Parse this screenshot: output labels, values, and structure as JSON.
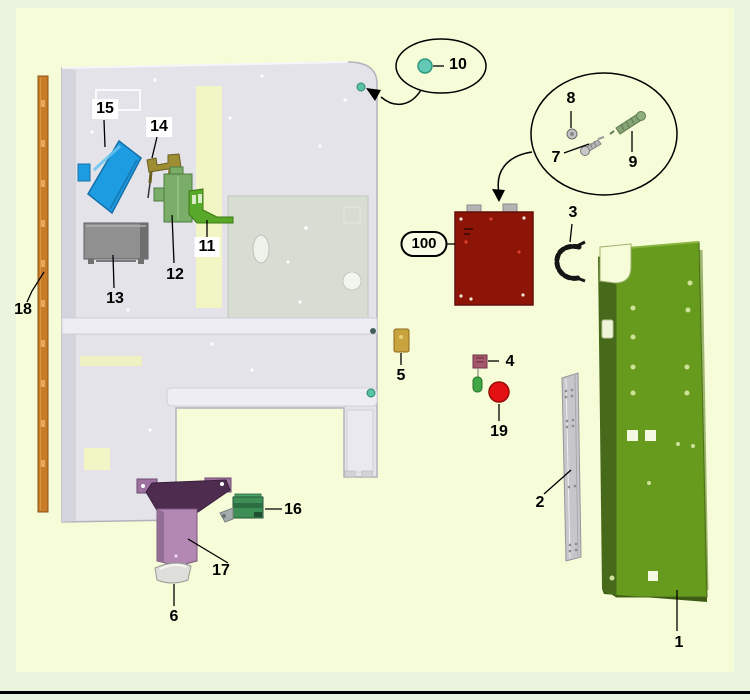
{
  "diagram": {
    "type": "exploded-parts-diagram",
    "callouts": {
      "c1": "1",
      "c2": "2",
      "c3": "3",
      "c4": "4",
      "c5": "5",
      "c6": "6",
      "c7": "7",
      "c8": "8",
      "c9": "9",
      "c10": "10",
      "c11": "11",
      "c12": "12",
      "c13": "13",
      "c14": "14",
      "c15": "15",
      "c16": "16",
      "c17": "17",
      "c18": "18",
      "c19": "19",
      "c100": "100"
    },
    "palette": {
      "background_outer": "#ebf4de",
      "background_inner": "#f6fbd8",
      "bottom_rule": "#000000",
      "mounting_panel": "#e3e3e9",
      "panel_recess": "#d7ddd3",
      "panel_yellow_strip": "#f2f5c4",
      "green_cabinet": "#679b1e",
      "green_cabinet_side": "#47691a",
      "red_module": "#8c1507",
      "blue_chute": "#1e9ce2",
      "purple_hopper_body": "#b287b2",
      "purple_hopper_top": "#4e2c50",
      "white_scoop": "#dededa",
      "brown_rail": "#c97c28",
      "gray_rail": "#c6c6cb",
      "gray_box": "#909090",
      "green_bracket_bright": "#58a829",
      "green_bracket_medium": "#79ad68",
      "olive_bracket": "#9d8d33",
      "green_block": "#3d8f55",
      "tan_block": "#c9a43e",
      "pink_block": "#a5586a",
      "green_pill": "#3fa844",
      "red_knob": "#e31111",
      "teal_plug": "#63c8b4",
      "callout_line": "#000000"
    }
  }
}
